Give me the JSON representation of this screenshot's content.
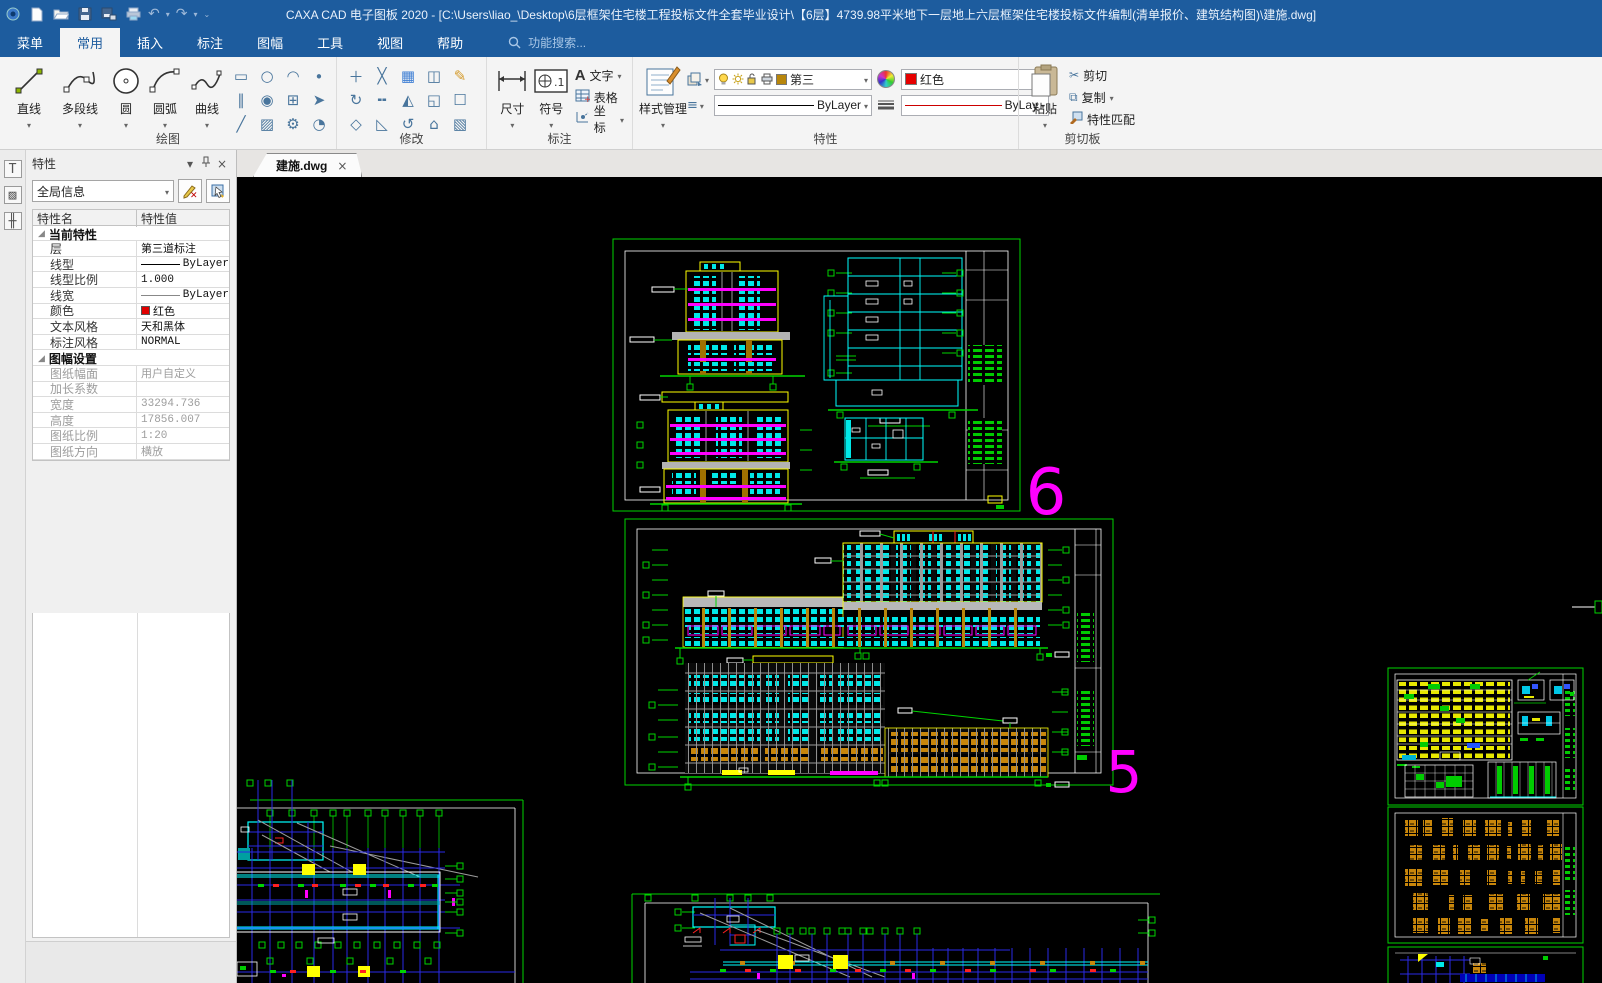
{
  "title_bar": {
    "app_title": "CAXA CAD 电子图板 2020 - [C:\\Users\\liao_\\Desktop\\6层框架住宅楼工程投标文件全套毕业设计\\【6层】4739.98平米地下一层地上六层框架住宅楼投标文件编制(清单报价、建筑结构图)\\建施.dwg]"
  },
  "menu": {
    "tabs": [
      "菜单",
      "常用",
      "插入",
      "标注",
      "图幅",
      "工具",
      "视图",
      "帮助"
    ],
    "active": "常用",
    "search_label": "功能搜索..."
  },
  "ribbon": {
    "draw_group": {
      "label": "绘图",
      "big_buttons": [
        "直线",
        "多段线",
        "圆",
        "圆弧",
        "曲线"
      ],
      "small_icons": [
        "▭",
        "○",
        "◠",
        "∙",
        "∥",
        "◉",
        "⊞",
        "➤",
        "╱",
        "▨",
        "⚙",
        "◔"
      ]
    },
    "modify_group": {
      "label": "修改",
      "small_icons": [
        "＋",
        "╳",
        "▦",
        "◫",
        "✎",
        "↻",
        "╍",
        "◭",
        "◱",
        "☐",
        "◇",
        "◺",
        "↺",
        "⌂",
        "▧"
      ]
    },
    "annotate_group": {
      "label": "标注",
      "big_buttons": [
        "尺寸",
        "符号"
      ],
      "stack": [
        "文字",
        "表格",
        "坐标"
      ]
    },
    "properties_group": {
      "label": "特性",
      "style_button": "样式管理",
      "layer_value": "第三",
      "color_value": "红色",
      "linetype_value": "ByLayer",
      "lineweight_value": "ByLay"
    },
    "clipboard_group": {
      "label": "剪切板",
      "paste_button": "粘贴",
      "stack": [
        "剪切",
        "复制",
        "特性匹配"
      ]
    }
  },
  "properties_panel": {
    "title": "特性",
    "selector_value": "全局信息",
    "columns": [
      "特性名",
      "特性值"
    ],
    "groups": [
      {
        "name": "当前特性",
        "disabled": false,
        "rows": [
          {
            "name": "层",
            "value": "第三道标注"
          },
          {
            "name": "线型",
            "value": "ByLayer",
            "line": "solid"
          },
          {
            "name": "线型比例",
            "value": "1.000"
          },
          {
            "name": "线宽",
            "value": "ByLayer",
            "line": "thin"
          },
          {
            "name": "颜色",
            "value": "红色",
            "swatch": "#e00000"
          },
          {
            "name": "文本风格",
            "value": "天和黑体"
          },
          {
            "name": "标注风格",
            "value": "NORMAL"
          }
        ]
      },
      {
        "name": "图幅设置",
        "disabled": true,
        "rows": [
          {
            "name": "图纸幅面",
            "value": "用户自定义"
          },
          {
            "name": "加长系数",
            "value": ""
          },
          {
            "name": "宽度",
            "value": "33294.736"
          },
          {
            "name": "高度",
            "value": "17856.007"
          },
          {
            "name": "图纸比例",
            "value": "1:20"
          },
          {
            "name": "图纸方向",
            "value": "横放"
          }
        ]
      }
    ]
  },
  "document_tabs": [
    {
      "label": "建施.dwg"
    }
  ],
  "canvas": {
    "labels": [
      {
        "text": "6"
      },
      {
        "text": "5"
      }
    ]
  },
  "icon_glyphs": {
    "undo": "↶",
    "redo": "↷",
    "cut": "✂",
    "copy": "⧉",
    "close": "×",
    "dropdown": "▾"
  },
  "colors": {
    "titlebar_blue": "#1d5c9e",
    "cad_green": "#00d400",
    "cad_cyan": "#00ffff",
    "cad_magenta": "#ff00ff",
    "cad_yellow": "#ffff00",
    "cad_orange": "#c8860b",
    "cad_blue": "#2a2ae6",
    "cad_red": "#ff2020",
    "current_color": "#e00000"
  }
}
